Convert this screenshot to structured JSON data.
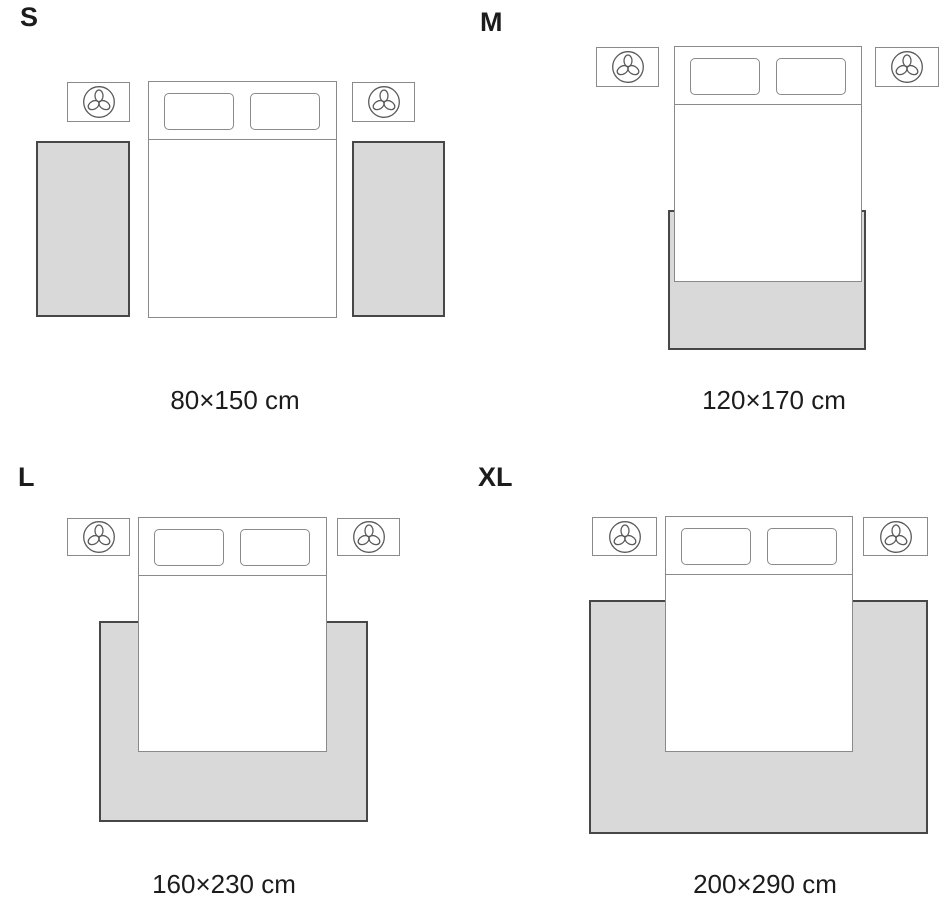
{
  "panels": [
    {
      "label": "S",
      "dimension": "80×150 cm"
    },
    {
      "label": "M",
      "dimension": "120×170 cm"
    },
    {
      "label": "L",
      "dimension": "160×230 cm"
    },
    {
      "label": "XL",
      "dimension": "200×290 cm"
    }
  ],
  "icons": {
    "nightstand_icon": "plant-icon"
  },
  "colors": {
    "background": "#ffffff",
    "rug_fill": "#d9d9d9",
    "rug_border": "#474747",
    "furniture_border": "#8a8a8a",
    "text_color": "#1c1c1c"
  }
}
